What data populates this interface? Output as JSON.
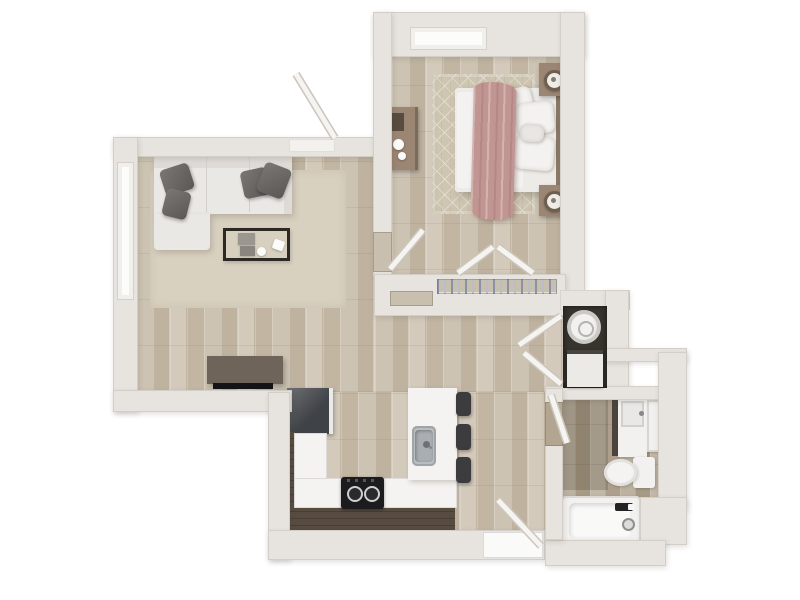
{
  "meta": {
    "title": "One-bedroom apartment - 3D top-view floor plan",
    "view": "top-down 3D render",
    "background": "#ffffff"
  },
  "palette": {
    "wall": "#e7e4df",
    "wall_recess": "#f3f1ee",
    "wood_floor": "#c6bbaa",
    "wood_floor_dark": "#b2a693",
    "rug_living": "#d9d1c0",
    "rug_bedroom": "#cfc6b2",
    "cabinet_espresso": "#584c41",
    "countertop": "#f4f3f1",
    "appliance_dark": "#3f4246",
    "stool_dark": "#3c3c3f",
    "sofa_white": "#eae8e5",
    "pillow_gray": "#6e6a67",
    "blanket_pink": "#c19692",
    "wood_furniture_tan": "#9b8573",
    "fixture_white": "#f2f1ef",
    "stainless": "#b9bdc0",
    "laundry_alcove": "#37332d",
    "hanger_blue": "#8992a6"
  },
  "rooms": {
    "living": {
      "label": "Living Room",
      "items": [
        "sectional-sofa",
        "throw-pillows x4",
        "coffee-table",
        "media-console",
        "tv",
        "area-rug",
        "window"
      ]
    },
    "bedroom": {
      "label": "Bedroom",
      "items": [
        "double-bed",
        "pink-throw-blanket",
        "pillows",
        "nightstand x2",
        "table-lamp x2",
        "dresser",
        "diamond-rug",
        "window"
      ]
    },
    "closet": {
      "label": "Closet",
      "items": [
        "hanging-rod-with-clothes",
        "double-doors"
      ]
    },
    "hall": {
      "label": "Hallway",
      "items": []
    },
    "kitchen": {
      "label": "Kitchen",
      "items": [
        "refrigerator",
        "l-shaped-counter",
        "cooktop",
        "island-with-sink",
        "bar-stool x3"
      ]
    },
    "laundry": {
      "label": "Laundry Closet",
      "items": [
        "washer",
        "dryer",
        "double-doors"
      ]
    },
    "bathroom": {
      "label": "Bathroom",
      "items": [
        "vanity-with-sink",
        "mirror",
        "toilet",
        "bathtub"
      ]
    },
    "entry": {
      "label": "Entry",
      "items": [
        "entry-door"
      ]
    }
  },
  "doors": {
    "front": "front door (top, open outward)",
    "bedroom": "bedroom door (open)",
    "closet_left": "closet door left leaf (open)",
    "closet_right": "closet door right leaf (open)",
    "laundry_top": "laundry closet upper leaf (open)",
    "laundry_bottom": "laundry closet lower leaf (open)",
    "bathroom": "bathroom door (open)",
    "entry": "entry door (bottom, open inward)"
  }
}
